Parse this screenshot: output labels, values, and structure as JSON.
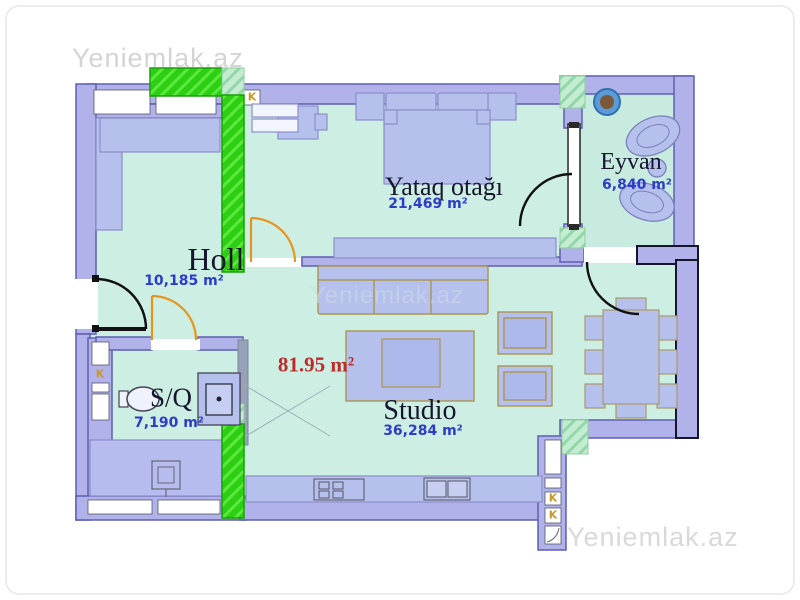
{
  "watermarks": {
    "top_left": "Yeniemlak.az",
    "center": "Yeniemlak.az",
    "bottom_right": "Yeniemlak.az"
  },
  "total_area_label": "81.95 m²",
  "rooms": {
    "yataq": {
      "name": "Yataq otağı",
      "area": "21,469 m²"
    },
    "eyvan": {
      "name": "Eyvan",
      "area": "6,840 m²"
    },
    "holl": {
      "name": "Holl",
      "area": "10,185 m²"
    },
    "sq": {
      "name": "S/Q",
      "area": "7,190 m²"
    },
    "studio": {
      "name": "Studio",
      "area": "36,284 m²"
    }
  },
  "shaft_label": "K",
  "colors": {
    "floor": "#cceee3",
    "wall": "#b0b2e9",
    "wall_stroke": "#5f5fb2",
    "shaft_green": "#2ccf12",
    "shaft_light": "#c4ecd0",
    "door_orange": "#e6941e",
    "door_dark": "#111111",
    "furniture": "#b6c0ec",
    "area_text": "#2b3cc8",
    "total_text": "#bf2b2b",
    "k_label": "#c8992e",
    "watermark": "#d4d4d4"
  }
}
